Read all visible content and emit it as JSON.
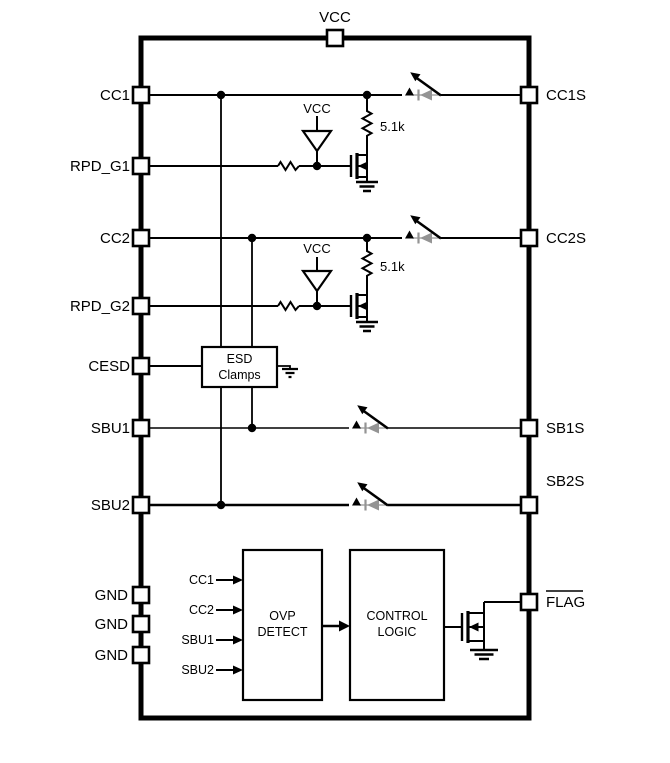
{
  "ic": {
    "top_pin": "VCC",
    "left_pins": [
      "CC1",
      "RPD_G1",
      "CC2",
      "RPD_G2",
      "CESD",
      "SBU1",
      "SBU2",
      "GND",
      "GND",
      "GND"
    ],
    "right_pins": [
      "CC1S",
      "CC2S",
      "SB1S",
      "SB2S",
      "FLAG"
    ],
    "flag_active_low": true
  },
  "internal": {
    "rail1": "VCC",
    "rail2": "VCC",
    "res1": "5.1k",
    "res2": "5.1k",
    "esd": {
      "line1": "ESD",
      "line2": "Clamps"
    },
    "ovp": {
      "line1": "OVP",
      "line2": "DETECT"
    },
    "control": {
      "line1": "CONTROL",
      "line2": "LOGIC"
    },
    "ovp_inputs": [
      "CC1",
      "CC2",
      "SBU1",
      "SBU2"
    ]
  },
  "colors": {
    "ink": "#000000",
    "diode_gray": "#949494",
    "background": "#ffffff"
  }
}
